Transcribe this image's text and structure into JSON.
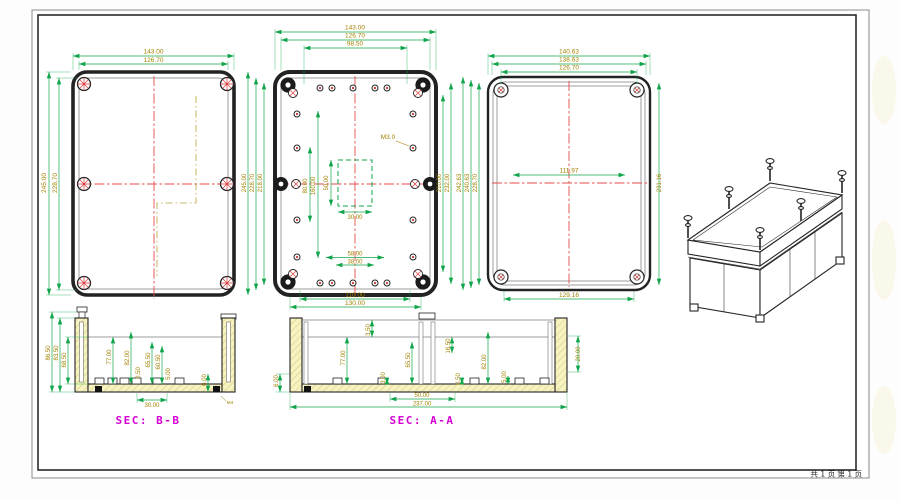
{
  "page": {
    "footer_page_info": "共 1 页  第 1 页"
  },
  "colors": {
    "dim_line": "#10a54a",
    "dim_text": "#a38200",
    "centerline": "#e84b4b",
    "section_label": "#d400d4",
    "outline": "#232323",
    "cut_hatch_fill": "#f6f3c0"
  },
  "views": {
    "top_left": {
      "dims_top": [
        "143.00",
        "126.70"
      ],
      "dims_left": [
        "245.00",
        "228.70"
      ]
    },
    "gap_left_middle": {
      "dims": [
        "245.00",
        "228.70",
        "218.00"
      ]
    },
    "top_middle": {
      "dims_top": [
        "143.00",
        "126.70",
        "98.50"
      ],
      "thread_label": "M3.0",
      "dims_inner_vertical": [
        "80.00",
        "160.00",
        "50.00"
      ],
      "dim_square_width": "30.00",
      "dims_bottom_inner": [
        "58.00",
        "38.00"
      ],
      "dims_bottom": [
        "110.00",
        "130.00"
      ],
      "dims_right": [
        "210.00",
        "232.00"
      ]
    },
    "top_right": {
      "dims_top": [
        "140.63",
        "138.63",
        "126.70"
      ],
      "dim_inner_width": "111.97",
      "dims_left": [
        "242.63",
        "240.63",
        "228.70"
      ],
      "dim_right": "231.16",
      "dim_bottom": "129.16"
    },
    "sec_bb": {
      "label": "SEC: B-B",
      "dims_left": [
        "86.50",
        "83.50",
        "68.50"
      ],
      "dims_inner": [
        "77.00",
        "82.00",
        "0.50",
        "65.50",
        "60.50",
        "5.00",
        "6.00"
      ],
      "dim_bottom": "30.00",
      "thread_label": "M4"
    },
    "sec_aa": {
      "label": "SEC: A-A",
      "dim_left": "6.00",
      "dims_inner": [
        "77.00",
        "3.50",
        "3.00",
        "65.50",
        "16.50",
        "0.50",
        "82.00",
        "5.00"
      ],
      "dim_right": "20.00",
      "dims_bottom": [
        "50.00",
        "237.00"
      ]
    }
  }
}
